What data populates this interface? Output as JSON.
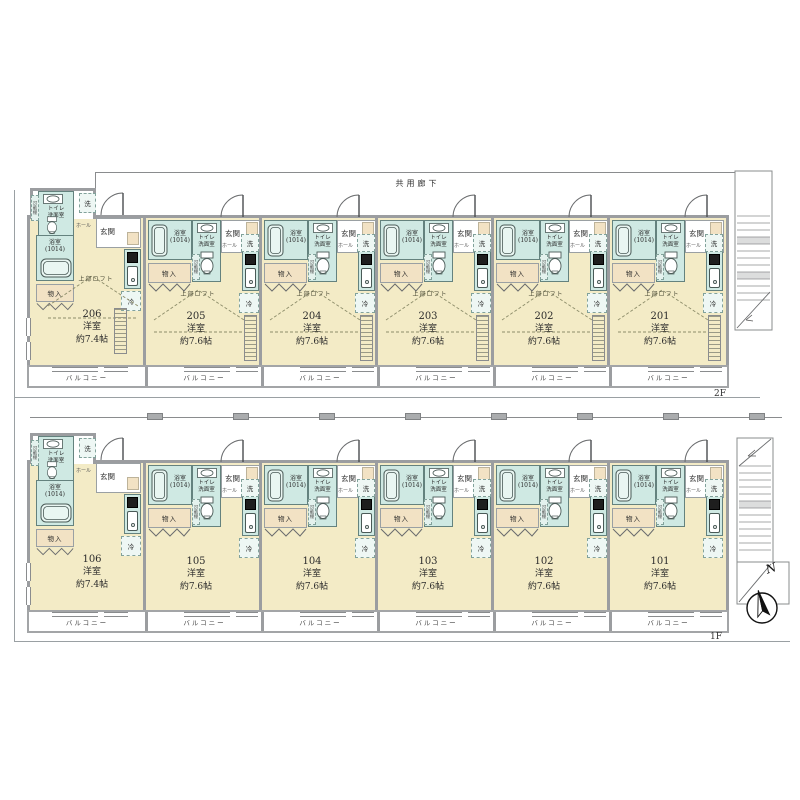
{
  "plan": {
    "type": "apartment-floor-plan",
    "floor_count": 2
  },
  "labels": {
    "corridor": "共用廊下",
    "entrance": "玄関",
    "hall": "ホール",
    "wash": "洗",
    "bath_line1": "浴室",
    "bath_line2": "(1014)",
    "toilet_line1": "トイレ",
    "toilet_line2": "洗面室",
    "shelf": "可動棚",
    "storage": "物入",
    "fridge": "冷",
    "loft": "上部ロフト",
    "balcony": "バルコニー"
  },
  "compass": {
    "north_label": "N"
  },
  "floors": [
    {
      "floor_label": "2F",
      "corridor_label": "共用廊下",
      "has_loft": true,
      "units": [
        {
          "number": "206",
          "type": "洋室",
          "size": "約7.4帖",
          "variant": "end"
        },
        {
          "number": "205",
          "type": "洋室",
          "size": "約7.6帖",
          "variant": "standard"
        },
        {
          "number": "204",
          "type": "洋室",
          "size": "約7.6帖",
          "variant": "standard"
        },
        {
          "number": "203",
          "type": "洋室",
          "size": "約7.6帖",
          "variant": "standard"
        },
        {
          "number": "202",
          "type": "洋室",
          "size": "約7.6帖",
          "variant": "standard"
        },
        {
          "number": "201",
          "type": "洋室",
          "size": "約7.6帖",
          "variant": "standard"
        }
      ]
    },
    {
      "floor_label": "1F",
      "has_loft": false,
      "units": [
        {
          "number": "106",
          "type": "洋室",
          "size": "約7.4帖",
          "variant": "end"
        },
        {
          "number": "105",
          "type": "洋室",
          "size": "約7.6帖",
          "variant": "standard"
        },
        {
          "number": "104",
          "type": "洋室",
          "size": "約7.6帖",
          "variant": "standard"
        },
        {
          "number": "103",
          "type": "洋室",
          "size": "約7.6帖",
          "variant": "standard"
        },
        {
          "number": "102",
          "type": "洋室",
          "size": "約7.6帖",
          "variant": "standard"
        },
        {
          "number": "101",
          "type": "洋室",
          "size": "約7.6帖",
          "variant": "standard"
        }
      ]
    }
  ]
}
